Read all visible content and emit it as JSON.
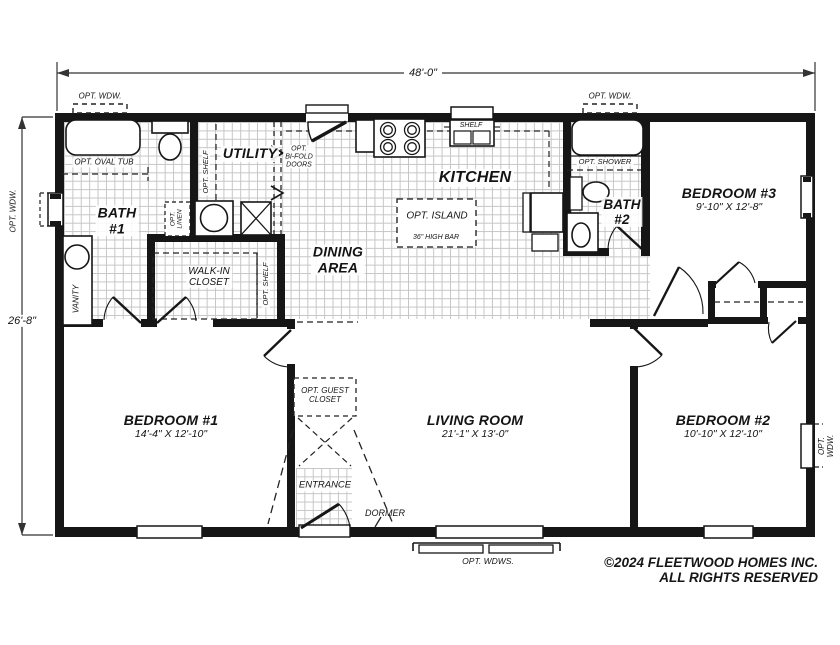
{
  "dimensions": {
    "width": "48'-0\"",
    "height": "26'-8\""
  },
  "rooms": {
    "bath1": {
      "label": "BATH\n#1"
    },
    "utility": {
      "label": "UTILITY"
    },
    "kitchen": {
      "label": "KITCHEN"
    },
    "dining": {
      "label": "DINING\nAREA"
    },
    "walk_in_closet": {
      "label": "WALK-IN\nCLOSET"
    },
    "bath2": {
      "label": "BATH\n#2"
    },
    "bedroom1": {
      "label": "BEDROOM #1",
      "dims": "14'-4\" X 12'-10\""
    },
    "bedroom2": {
      "label": "BEDROOM #2",
      "dims": "10'-10\" X 12'-10\""
    },
    "bedroom3": {
      "label": "BEDROOM #3",
      "dims": "9'-10\" X 12'-8\""
    },
    "living_room": {
      "label": "LIVING ROOM",
      "dims": "21'-1\" X 13'-0\""
    },
    "entrance": {
      "label": "ENTRANCE"
    }
  },
  "annotations": {
    "opt_wdw": "OPT. WDW.",
    "opt_wdws": "OPT. WDWS.",
    "opt_oval_tub": "OPT. OVAL TUB",
    "opt_shelf": "OPT. SHELF",
    "opt_linen": "OPT.\nLINEN",
    "opt_bifold_doors": "OPT.\nBI-FOLD\nDOORS",
    "opt_shower": "OPT. SHOWER",
    "opt_island": "OPT. ISLAND",
    "high_bar": "36\" HIGH BAR",
    "shelf": "SHELF",
    "vanity": "VANITY",
    "opt_guest_closet": "OPT. GUEST\nCLOSET",
    "dormer": "DORMER"
  },
  "footer": {
    "copyright": "©2024 FLEETWOOD HOMES INC.",
    "rights": "ALL RIGHTS RESERVED"
  }
}
